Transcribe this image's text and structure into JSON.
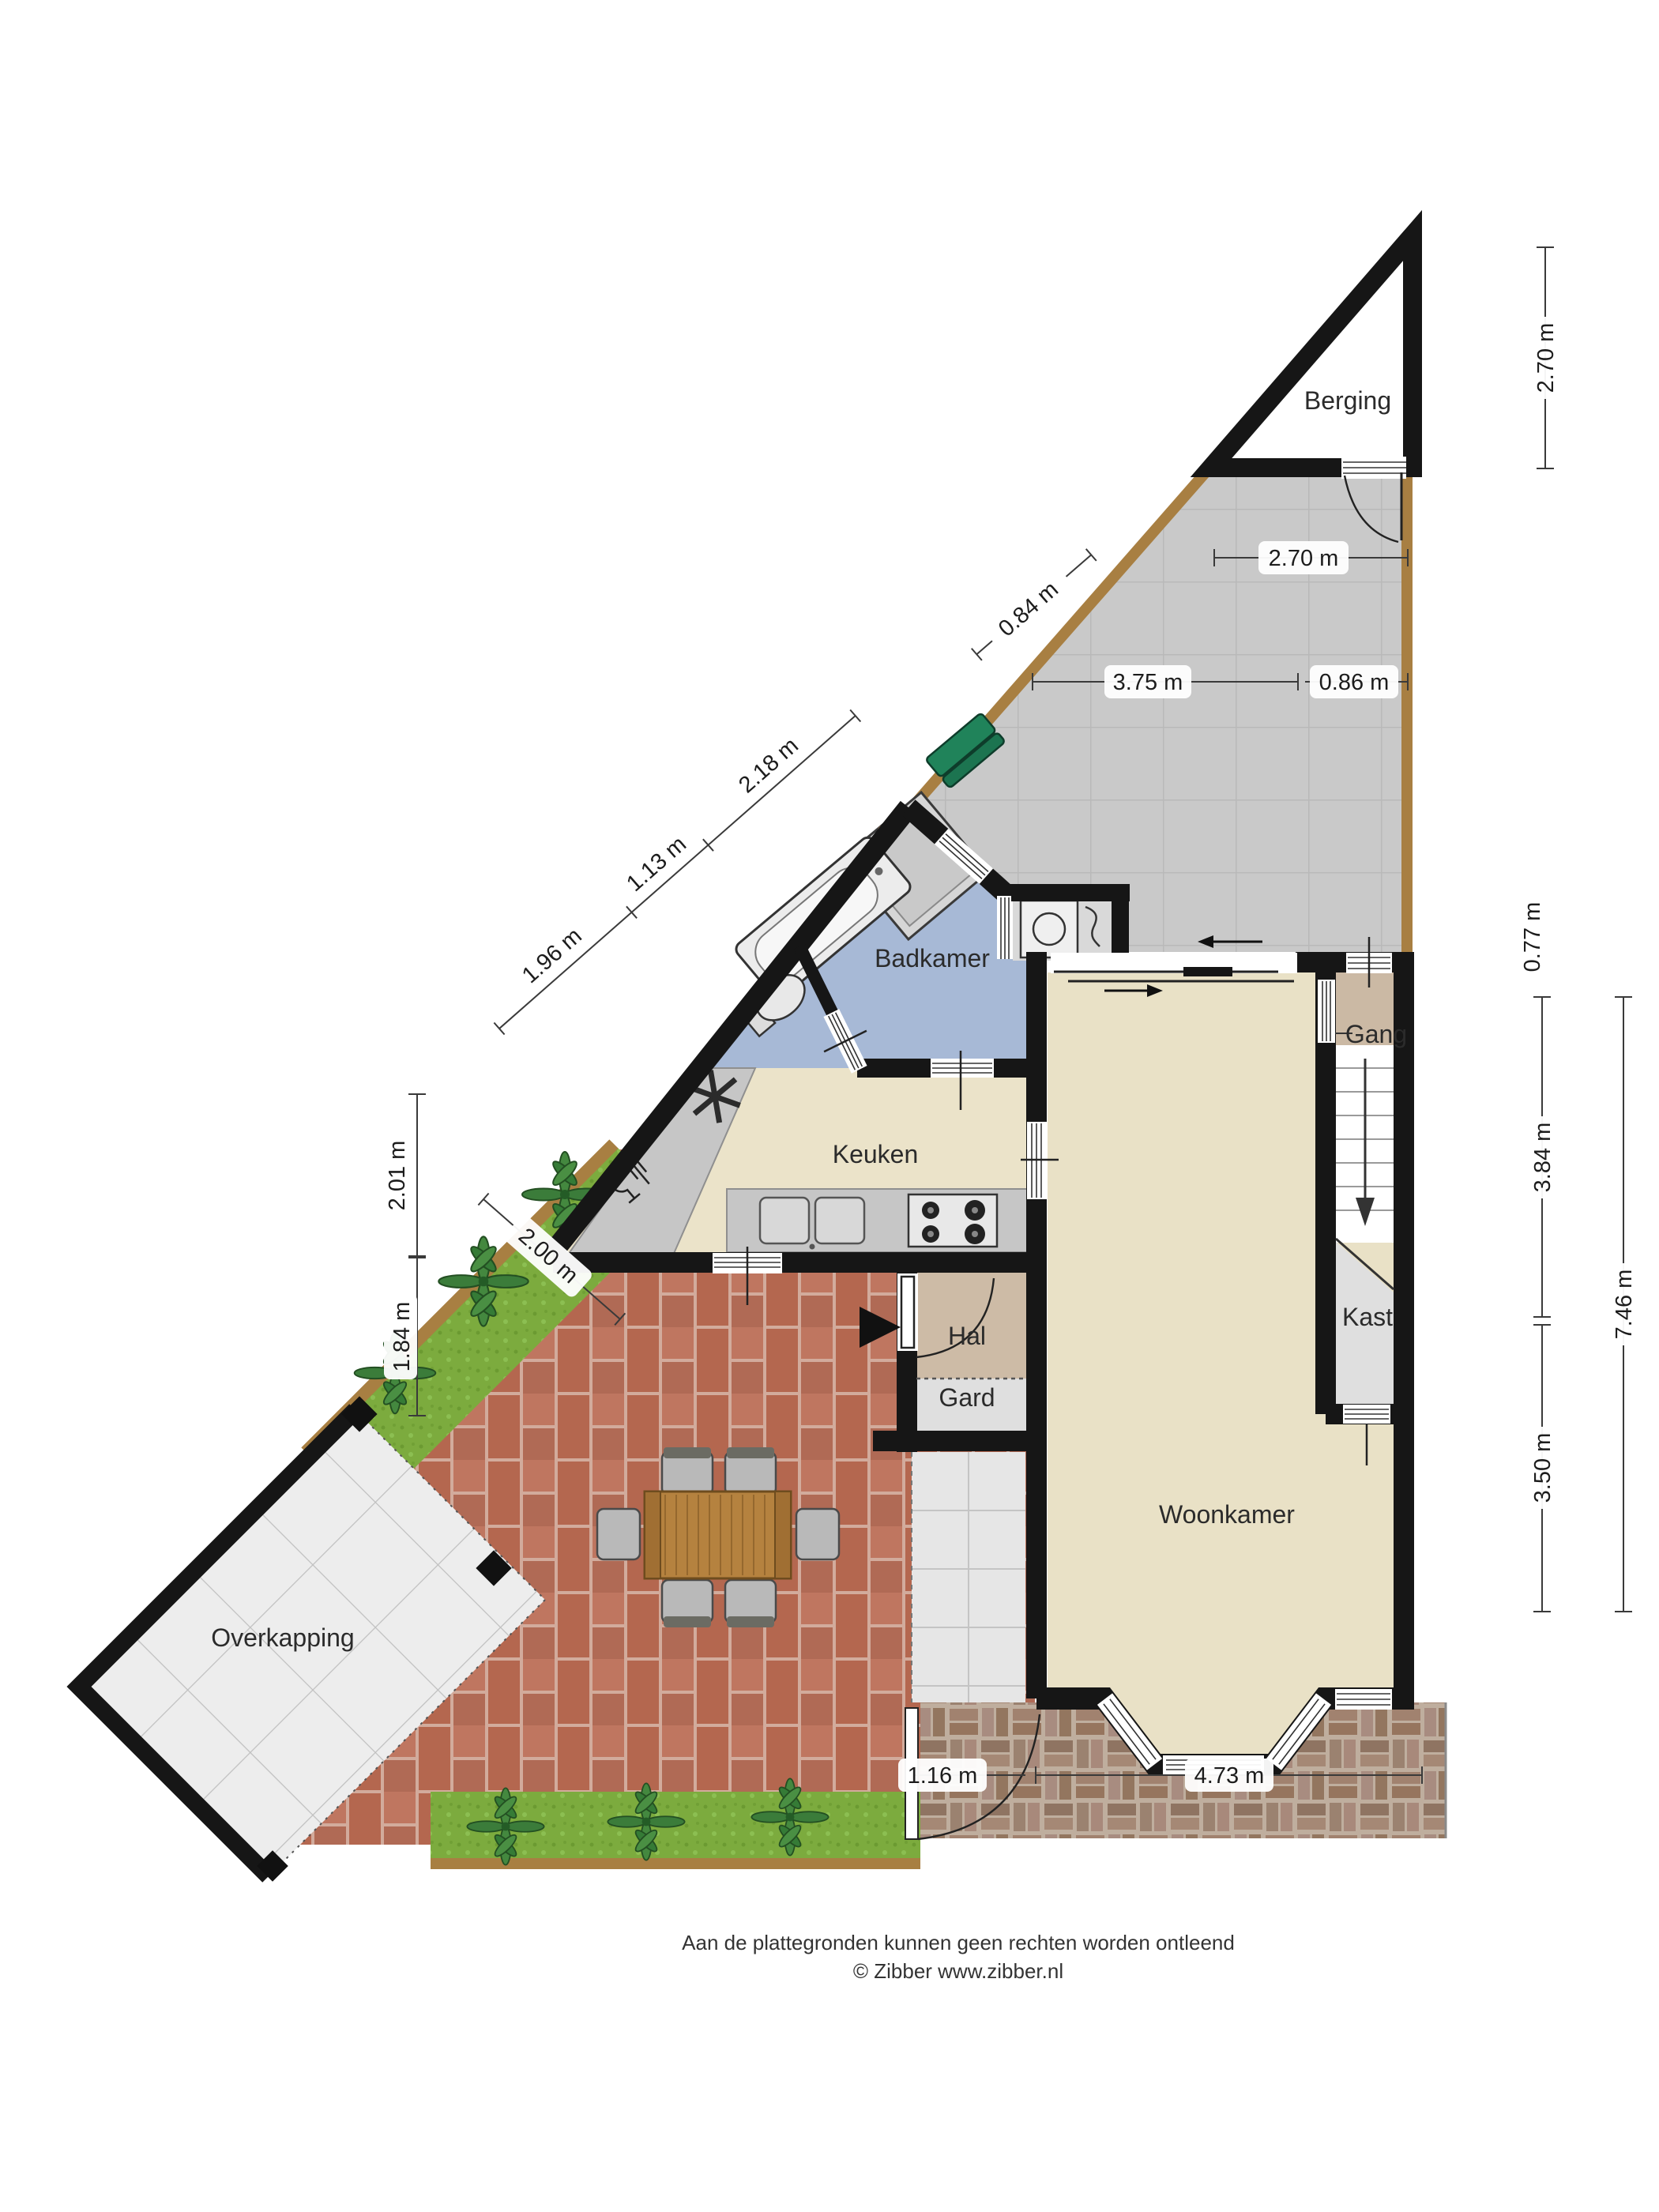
{
  "plan": {
    "title": "Begane grond plattegrond",
    "rooms": {
      "berging": "Berging",
      "badkamer": "Badkamer",
      "keuken": "Keuken",
      "gang": "Gang",
      "kast": "Kast",
      "hal": "Hal",
      "gard": "Gard",
      "woonkamer": "Woonkamer",
      "overkapping": "Overkapping"
    },
    "dimensions": {
      "berging_height": "2.70 m",
      "path_width": "2.70 m",
      "diag_084": "0.84 m",
      "path_375": "3.75 m",
      "path_086": "0.86 m",
      "chain_196": "1.96 m",
      "chain_113": "1.13 m",
      "chain_218": "2.18 m",
      "left_201": "2.01 m",
      "left_184": "1.84 m",
      "grass_200": "2.00 m",
      "right_077": "0.77 m",
      "right_384": "3.84 m",
      "right_350": "3.50 m",
      "right_746": "7.46 m",
      "bottom_116": "1.16 m",
      "bottom_473": "4.73 m"
    },
    "footer": {
      "line1": "Aan de plattegronden kunnen geen rechten worden ontleend",
      "line2": "© Zibber www.zibber.nl"
    },
    "colors": {
      "wall": "#161616",
      "berging_floor": "#e6e6e8",
      "path_tile": "#c9c9c9",
      "wood": "#a87f42",
      "bathroom": "#a7b9d6",
      "kitchen": "#ebe3c9",
      "living": "#e9e1c6",
      "hall": "#cdbba6",
      "gang": "#cbb9a4",
      "closet": "#dfdfdf",
      "counter": "#c6c6c6",
      "patio_brick": "#b4674f",
      "patio_brick_alt": "#bf7660",
      "sidewalk": "#a1826f",
      "grass": "#7cab3e",
      "plant": "#3b7c3a",
      "bench": "#20835a",
      "table_wood": "#b5823f",
      "pergola_tile": "#ededed"
    }
  }
}
